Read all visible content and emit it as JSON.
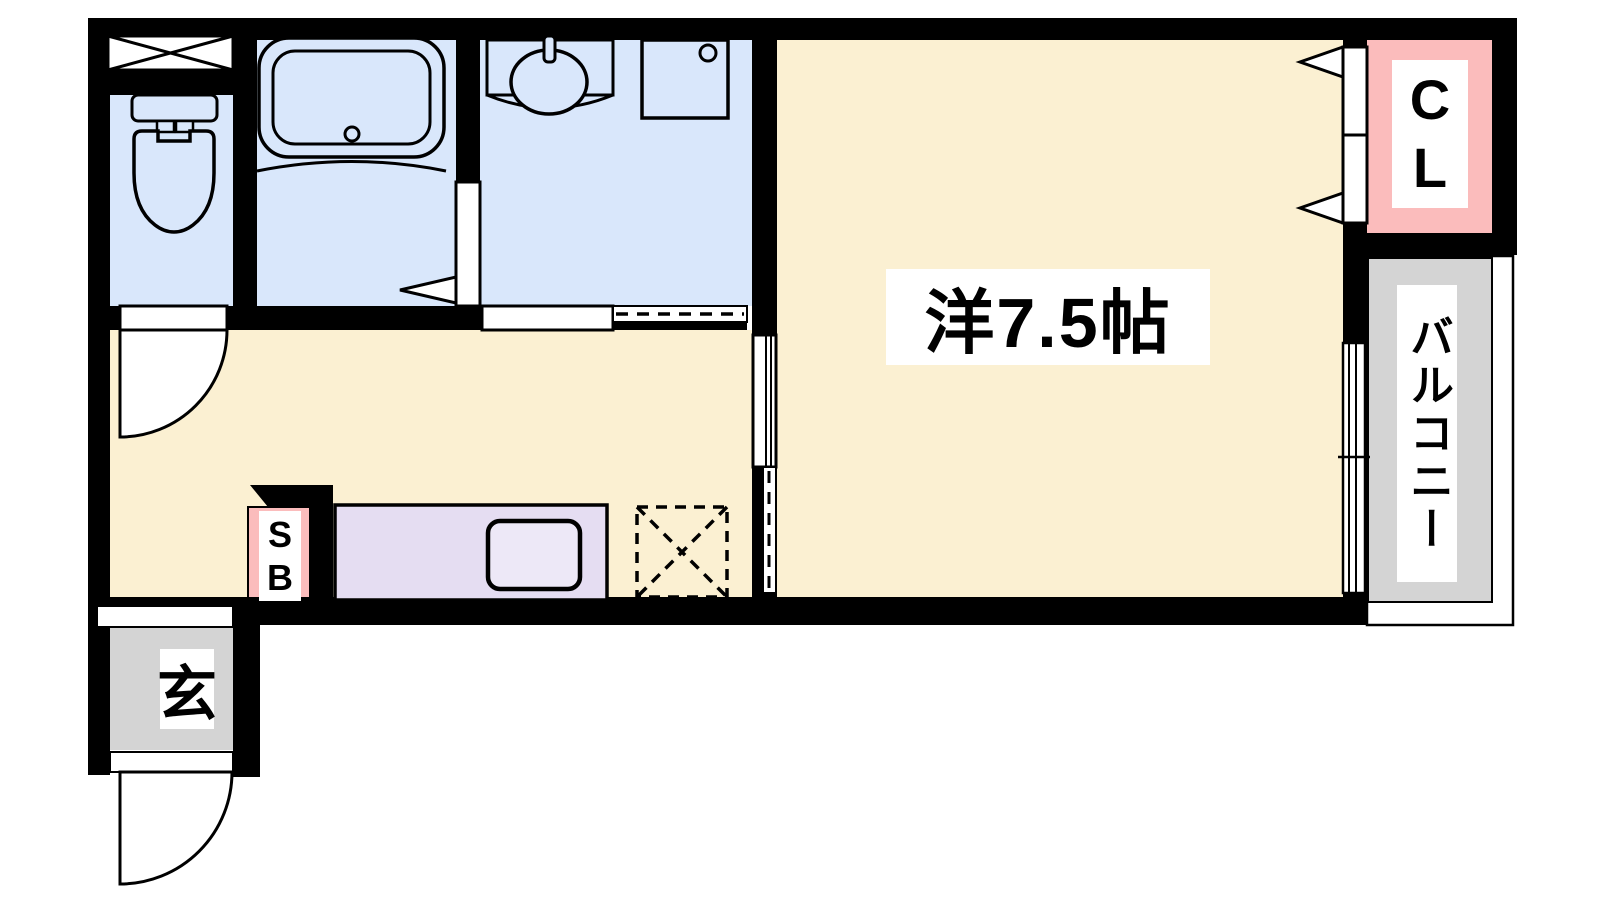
{
  "labels": {
    "main_room": "洋7.5帖",
    "closet": [
      "C",
      "L"
    ],
    "shoe_box": [
      "S",
      "B"
    ],
    "balcony": "バルコニー",
    "entrance": "玄"
  },
  "colors": {
    "wall": "#000000",
    "wet_area_blue": "#D9E7FB",
    "living_cream": "#FBF0D2",
    "closet_pink": "#FBBCBC",
    "kitchen_counter_lavender": "#E5DDF2",
    "kitchen_sink_fill": "#EDE8F7",
    "outdoor_gray": "#D4D4D4",
    "door_white": "#FFFFFF",
    "fixture_line": "#000000"
  },
  "fixtures": [
    "window-x-icon",
    "toilet-icon",
    "bathtub-icon",
    "wash-basin-icon",
    "washing-machine-pan-icon",
    "kitchen-sink-icon",
    "refrigerator-space-icon",
    "hinged-door-arc-icon",
    "sliding-door-icon",
    "closet-double-door-icon",
    "balcony-sliding-window-icon"
  ]
}
